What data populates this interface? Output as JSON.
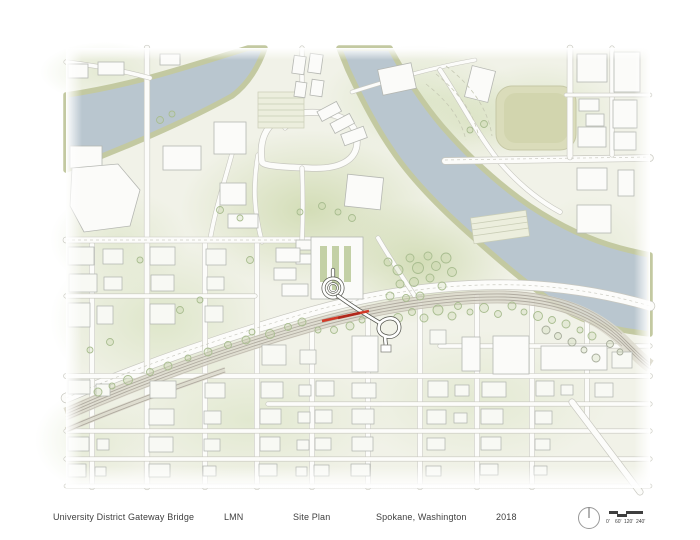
{
  "title_block": {
    "project": "University District Gateway Bridge",
    "firm": "LMN",
    "sheet": "Site Plan",
    "location": "Spokane, Washington",
    "year": "2018"
  },
  "scale_bar": {
    "labels": [
      "0'",
      "60'",
      "120'",
      "240'"
    ]
  },
  "colors": {
    "accent_red": "#d23a28",
    "river": "#b9c6cf",
    "riverbank": "#c3c9a1",
    "land": "#f1f2e8",
    "vegetation": "#d8e2c0",
    "vegetation_dark": "#c9d6a6",
    "road_fill": "#fcfcfa",
    "road_casing": "#c7c7bf",
    "rail": "#b0aba0",
    "building_fill": "#fbfbf9",
    "building_stroke": "#b5b7b2",
    "tree_stroke": "#a9bd90",
    "stadium_fill": "#dadcba",
    "bridge_stroke": "#55564f",
    "text": "#3f3f3f"
  }
}
